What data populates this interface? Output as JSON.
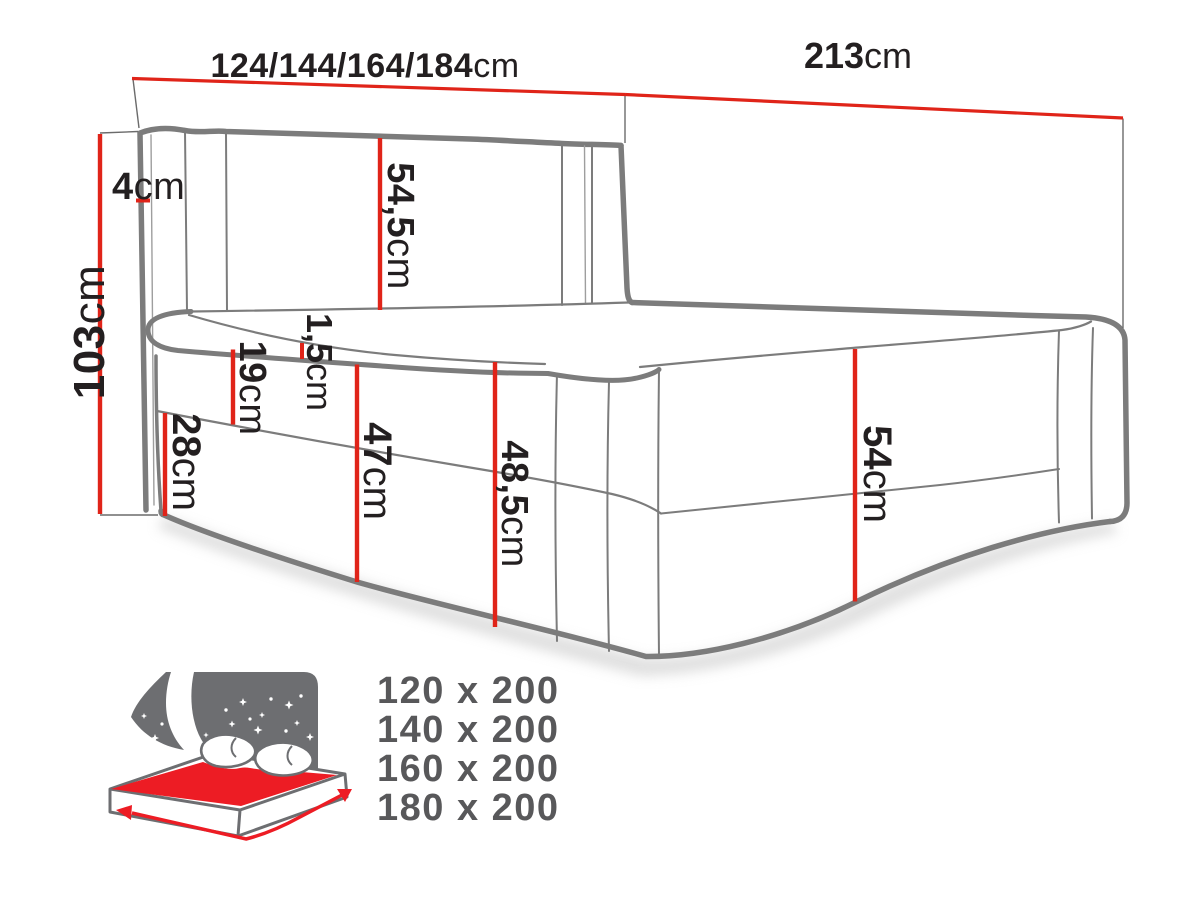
{
  "title": "boxspring-bed-dimension-diagram",
  "dimensions": {
    "width_options": {
      "value": "124/144/164/184",
      "unit": "cm"
    },
    "length": {
      "value": "213",
      "unit": "cm"
    },
    "total_height": {
      "value": "103",
      "unit": "cm"
    },
    "side_panel": {
      "value": "4",
      "unit": "cm"
    },
    "headboard_above_mattress": {
      "value": "54,5",
      "unit": "cm"
    },
    "mattress_lip": {
      "value": "1,5",
      "unit": "cm"
    },
    "mattress_height": {
      "value": "19",
      "unit": "cm"
    },
    "box_height": {
      "value": "28",
      "unit": "cm"
    },
    "front_height": {
      "value": "47",
      "unit": "cm"
    },
    "front_total_height": {
      "value": "48,5",
      "unit": "cm"
    },
    "side_height": {
      "value": "54",
      "unit": "cm"
    }
  },
  "sizes": {
    "items": [
      "120 x 200",
      "140 x 200",
      "160 x 200",
      "180 x 200"
    ]
  },
  "icon": {
    "name": "storage-bed-night-icon"
  },
  "colors": {
    "dimension_red": "#e02419",
    "bed_line_gray": "#7c7c7c",
    "text_black": "#231f20",
    "size_text_gray": "#58585a",
    "icon_gray": "#6d6e71",
    "icon_red": "#ed1c24"
  }
}
